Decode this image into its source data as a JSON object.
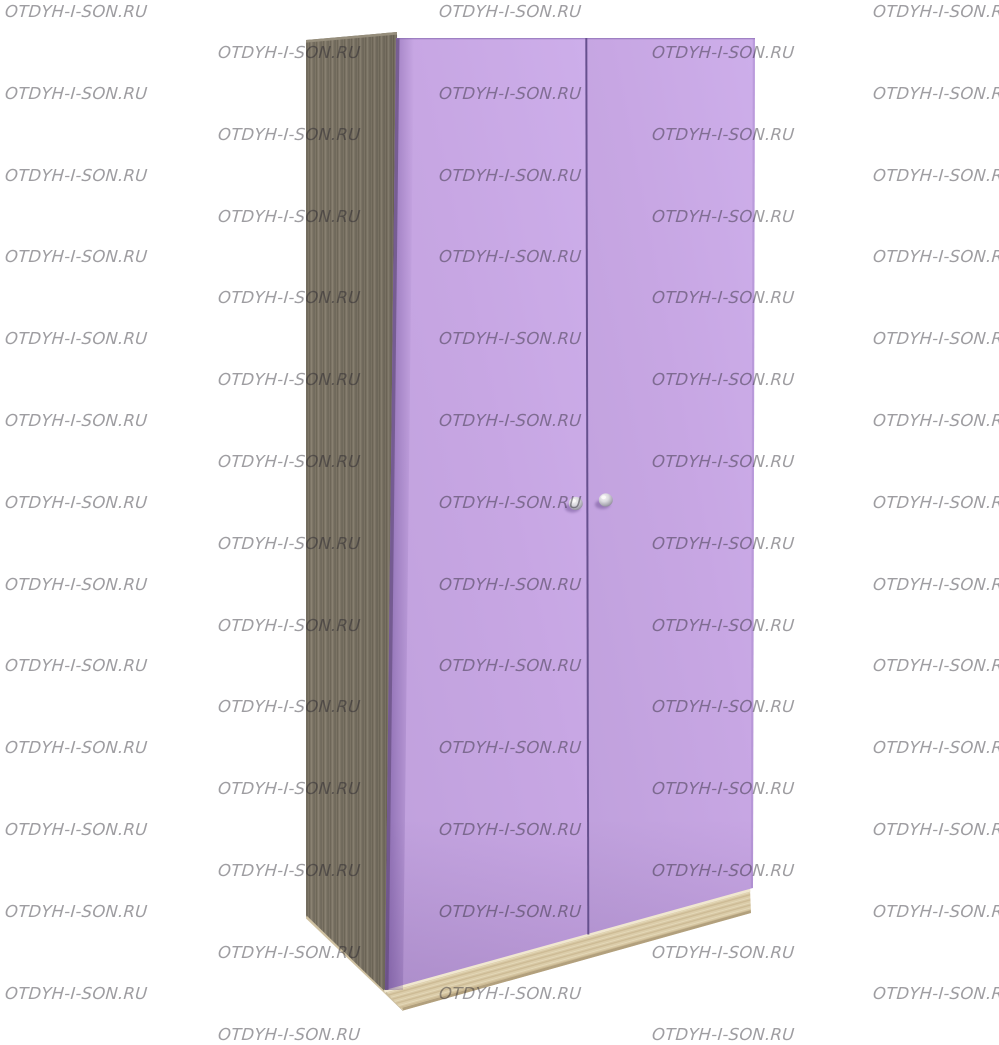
{
  "scene": {
    "type": "product-photo",
    "subject": "two-door wardrobe, front view with left side visible",
    "background_color": "#ffffff",
    "parts": {
      "side_panel": {
        "material": "dark wood grain",
        "color": "#7e7667"
      },
      "left_door": {
        "color": "#c7a6e3"
      },
      "right_door": {
        "color": "#c7a6e3"
      },
      "door_edge_shadow_color": "#6b5487",
      "door_gap_line_color": "#66508e",
      "plinth": {
        "material": "light wood grain",
        "color": "#d7c7a4"
      },
      "handles": {
        "count": 2,
        "shape": "round knob",
        "color": "#c9c8cf"
      }
    }
  },
  "watermark": {
    "text": "OTDYH-I-SON.RU",
    "color": "rgba(35,32,42,0.44)",
    "font_size_px": 16.5,
    "rows": 26,
    "start_y": 3,
    "row_height": 40.9,
    "col_spacing": 434,
    "even_row_x": 5,
    "odd_row_x": 218,
    "canvas_width": 999
  }
}
